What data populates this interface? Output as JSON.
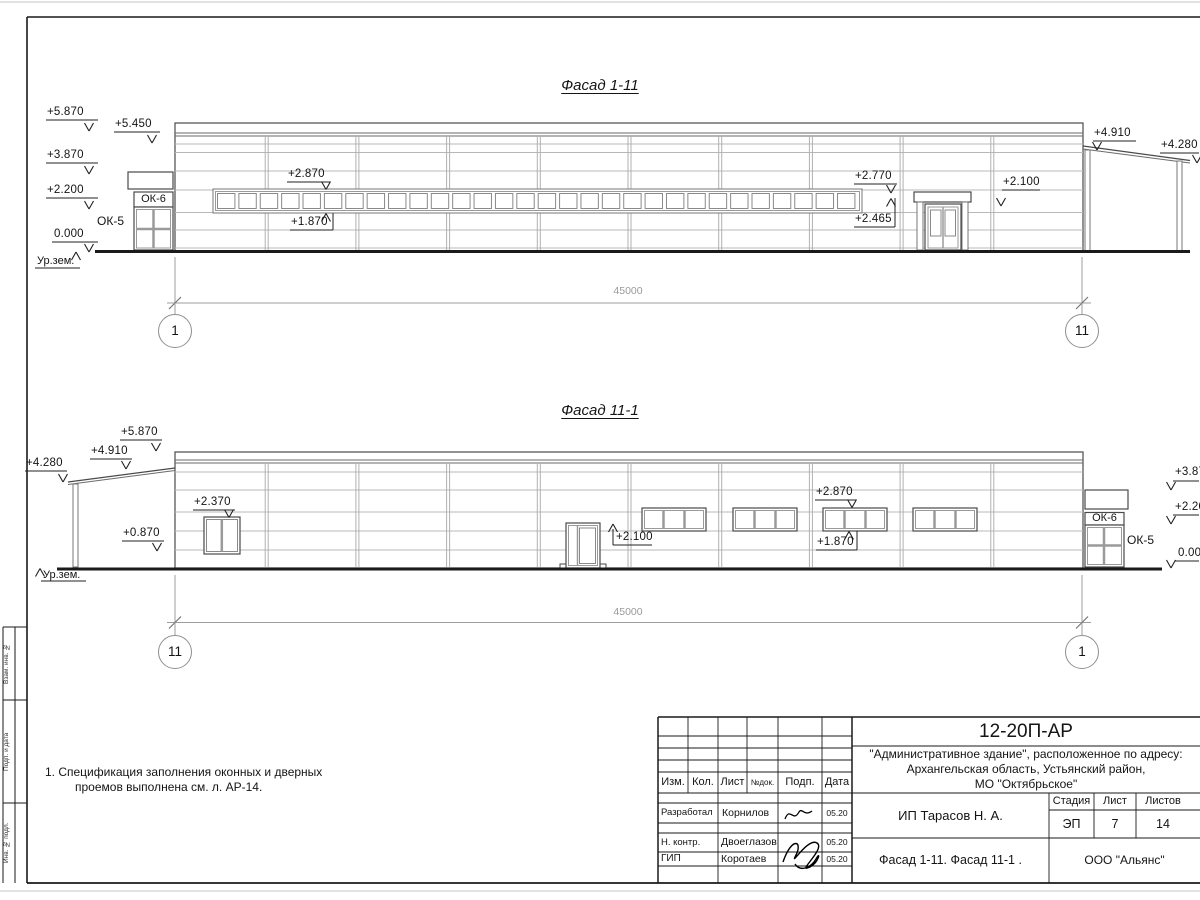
{
  "f1": {
    "title": "Фасад 1-11",
    "dim": "45000",
    "axis_left": "1",
    "axis_right": "11",
    "lvl_5870": "+5.870",
    "lvl_5450": "+5.450",
    "lvl_3870": "+3.870",
    "lvl_2200": "+2.200",
    "lvl_0000": "0.000",
    "ground_label": "Ур.зем.",
    "lvl_2870": "+2.870",
    "lvl_1870": "+1.870",
    "lvl_2770": "+2.770",
    "lvl_2465": "+2.465",
    "lvl_2100": "+2.100",
    "lvl_4910": "+4.910",
    "lvl_4280": "+4.280",
    "ok5": "ОК-5",
    "ok6": "ОК-6"
  },
  "f2": {
    "title": "Фасад 11-1",
    "dim": "45000",
    "axis_left": "11",
    "axis_right": "1",
    "lvl_4280": "+4.280",
    "lvl_4910": "+4.910",
    "lvl_5870": "+5.870",
    "lvl_2370": "+2.370",
    "lvl_0870": "+0.870",
    "ground_label": "Ур.зем.",
    "lvl_2100": "+2.100",
    "lvl_2870": "+2.870",
    "lvl_1870": "+1.870",
    "lvl_3870": "+3.870",
    "lvl_2200": "+2.200",
    "lvl_0000": "0.000",
    "ok5": "ОК-5",
    "ok6": "ОК-6"
  },
  "note": {
    "l1": "1. Спецификация заполнения оконных и дверных",
    "l2": "проемов выполнена см. л. АР-14."
  },
  "tb": {
    "doc_code": "12-20П-АР",
    "addr1": "\"Административное здание\", расположенное по адресу:",
    "addr2": "Архангельская область, Устьянский район,",
    "addr3": "МО \"Октябрьское\"",
    "h_izm": "Изм.",
    "h_kol": "Кол.",
    "h_list": "Лист",
    "h_ndok": "№док.",
    "h_podp": "Подп.",
    "h_data": "Дата",
    "r1_role": "Разработал",
    "r1_name": "Корнилов",
    "r1_date": "05.20",
    "r2_role": "Н. контр.",
    "r2_name": "Двоеглазов",
    "r2_date": "05.20",
    "r3_role": "ГИП",
    "r3_name": "Коротаев",
    "r3_date": "05.20",
    "client": "ИП Тарасов Н. А.",
    "h_stage": "Стадия",
    "h_sheet": "Лист",
    "h_sheets": "Листов",
    "stage": "ЭП",
    "sheet_no": "7",
    "sheets_total": "14",
    "sheet_title": "Фасад 1-11. Фасад 11-1 .",
    "company": "ООО \"Альянс\""
  },
  "stamp": {
    "s1": "Взам. инв. №",
    "s2": "Подп. и дата",
    "s3": "Инв. № подл."
  }
}
